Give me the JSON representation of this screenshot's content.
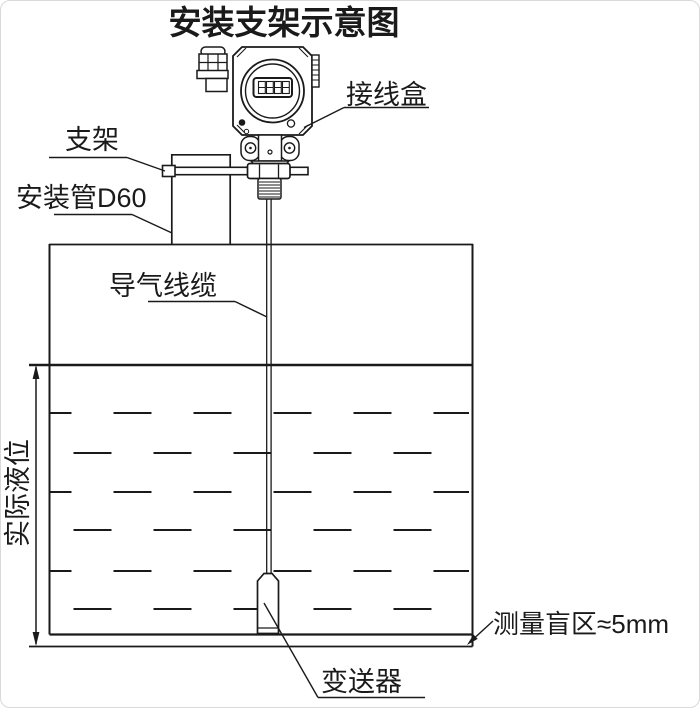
{
  "title": "安装支架示意图",
  "labels": {
    "junction_box": "接线盒",
    "bracket": "支架",
    "mounting_pipe": "安装管D60",
    "air_cable": "导气线缆",
    "actual_level": "实际液位",
    "transmitter": "变送器",
    "blind_zone": "测量盲区≈5mm"
  },
  "lcd": {
    "digit_count": 4
  },
  "colors": {
    "line": "#1a1a1a",
    "background": "#ffffff"
  }
}
